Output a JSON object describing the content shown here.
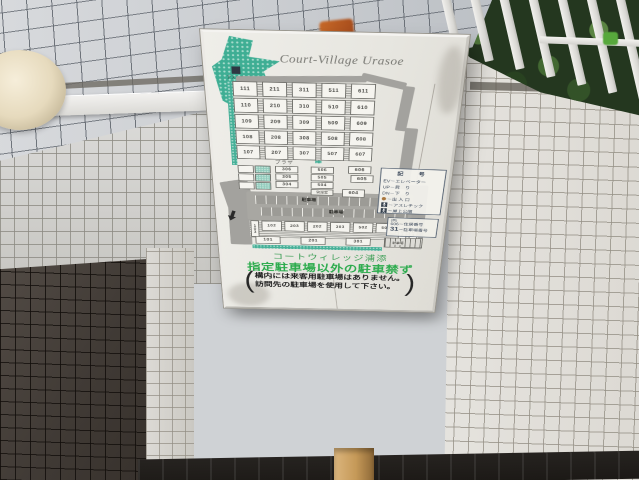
{
  "sign": {
    "title": "Court-Village Urasoe",
    "park_label": "アスレチック",
    "map": {
      "plaza_label": "プラザ",
      "main_grid": [
        [
          "111",
          "211",
          "311",
          "511",
          "611"
        ],
        [
          "110",
          "210",
          "310",
          "510",
          "610"
        ],
        [
          "109",
          "209",
          "309",
          "509",
          "609"
        ],
        [
          "108",
          "208",
          "308",
          "508",
          "608"
        ],
        [
          "107",
          "207",
          "307",
          "507",
          "607"
        ]
      ],
      "mid_left_units": [
        "306",
        "305",
        "304"
      ],
      "mid_right_units": [
        "506",
        "505",
        "504"
      ],
      "office_label": "管理室",
      "unit_604": "604",
      "unit_606": "606",
      "unit_605": "605",
      "lower_vertical_left": "103",
      "lower_units": [
        "102",
        "203",
        "202",
        "303",
        "502",
        "503"
      ],
      "lower_vertical_right": [
        "602",
        "603"
      ],
      "bottom_units": [
        "101",
        "201",
        "301"
      ],
      "parking_label_upper": "駐車場",
      "parking_label_lower": "駐車場",
      "small_parking_label": "駐車場"
    },
    "legend": {
      "title": "記　号",
      "rows": [
        {
          "icon": "",
          "text": "EV－エレベーター"
        },
        {
          "icon": "",
          "text": "UP－昇　り"
        },
        {
          "icon": "",
          "text": "DN－下　り"
        },
        {
          "icon": "entrance-dot",
          "text": "－出 入 口"
        },
        {
          "icon": "athletic",
          "text": "－アスレチック"
        },
        {
          "icon": "rooftop-park",
          "text": "－屋上公園"
        }
      ]
    },
    "example": {
      "header": "(例)",
      "line1_num": "606",
      "line1_label": "－住居番号",
      "line2_num": "31",
      "line2_label": "－駐車場番号"
    },
    "name_jp": "コートウィレッジ浦添",
    "warning_main": "指定駐車場以外の駐車禁ず",
    "warning_lines": [
      "構内には来客用駐車場はありません。",
      "訪問先の駐車場を使用して下さい。"
    ],
    "paren_open": "(",
    "paren_close": ")"
  },
  "colors": {
    "warning_green": "#2cab4d",
    "name_green": "#3f9f58",
    "landscape_teal": "#46b098",
    "road_gray": "#a3a29e",
    "sign_background": "#e9e8e2"
  }
}
